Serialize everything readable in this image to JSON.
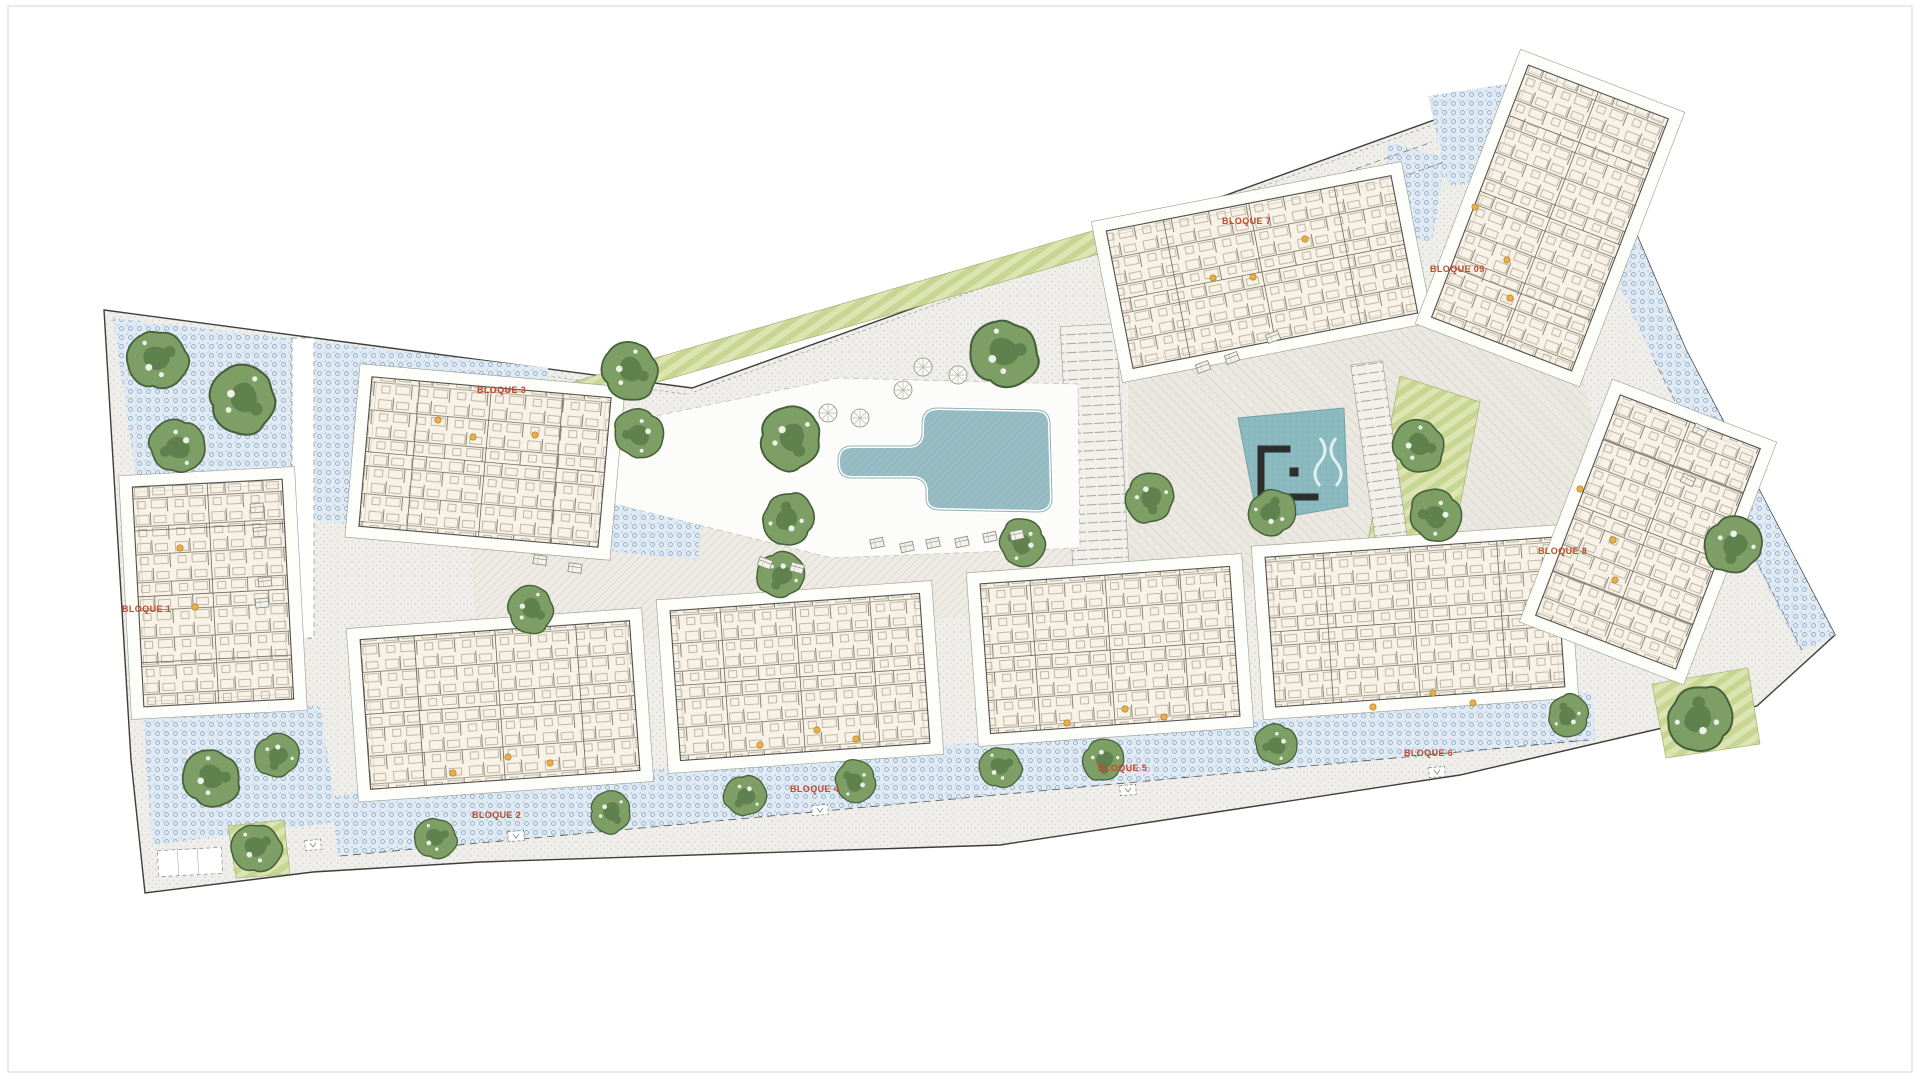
{
  "plan": {
    "blocks": [
      {
        "label": "BLOQUE 1"
      },
      {
        "label": "BLOQUE 2"
      },
      {
        "label": "BLOQUE 3"
      },
      {
        "label": "BLOQUE 4"
      },
      {
        "label": "BLOQUE 5"
      },
      {
        "label": "BLOQUE 6"
      },
      {
        "label": "BLOQUE 7"
      },
      {
        "label": "BLOQUE 8"
      },
      {
        "label": "BLOQUE 09"
      }
    ],
    "icons": {
      "tree": "tree-icon",
      "parasol": "parasol-icon",
      "lounge_chair": "lounge-chair-icon",
      "stair_core": "stair-core-dot",
      "elevator": "elevator-icon"
    }
  },
  "colors": {
    "label_red": "#c2492e",
    "paving_blue_dot": "#8fb2cf",
    "tree_green": "#7d9f65",
    "tree_dark": "#5e814d",
    "pool_teal": "#98bdc4",
    "playground_teal": "#8cbac1",
    "lawn_green": "#dce4b2",
    "building_cream": "#f7f2e5",
    "plaza_gray": "#efeeeb"
  }
}
